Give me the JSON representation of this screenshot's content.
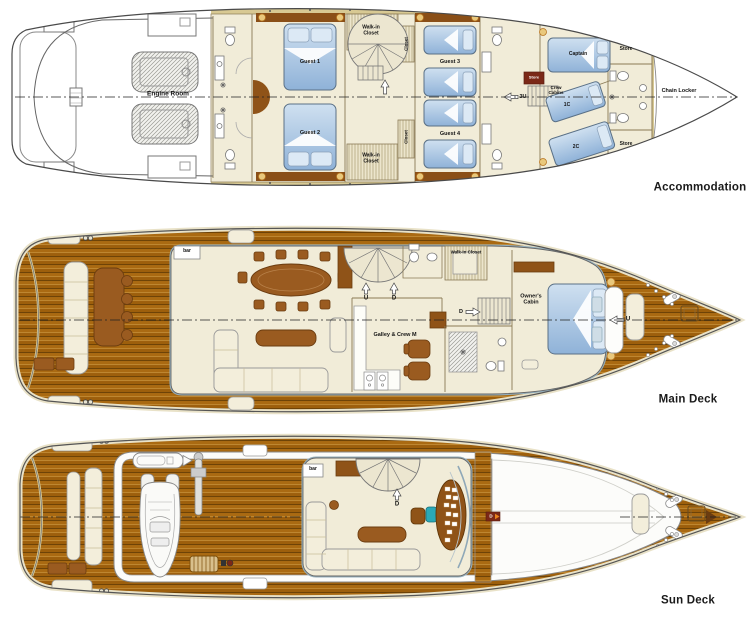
{
  "palette": {
    "background": "#ffffff",
    "hull_outline": "#4a4a4a",
    "teak_deck": "#a7660f",
    "teak_stripe": "#7d4e09",
    "gunwale_trim": "#d8c993",
    "interior_floor": "#f1ecd8",
    "bed_blue": "#a9c6e6",
    "furniture_brown": "#9a5b20",
    "store_red": "#7b2817",
    "helm_chair_teal": "#2aa9b8",
    "window_blue": "#93aebc"
  },
  "icons": [
    "double-bed-icon",
    "single-bed-icon",
    "bunk-bed-icon",
    "toilet-icon",
    "sink-icon",
    "shower-icon",
    "vent-fan-icon",
    "spiral-stairs-icon",
    "straight-stairs-icon",
    "up-arrow-icon",
    "down-arrow-icon",
    "left-arrow-icon",
    "right-arrow-icon",
    "dining-table-icon",
    "sofa-icon",
    "coffee-table-icon",
    "bar-counter-icon",
    "galley-stove-icon",
    "helm-console-icon",
    "helm-chair-icon",
    "engine-icon",
    "tender-boat-icon",
    "jetski-icon",
    "crane-icon",
    "boarding-steps-icon",
    "cleat-icon",
    "deck-hatch-icon",
    "anchor-windlass-icon"
  ],
  "decks": [
    {
      "id": "accommodation",
      "label": "Accommodation",
      "rooms": {
        "engine_room": "Engine Room",
        "guest1": "Guest 1",
        "guest2": "Guest 2",
        "guest3": "Guest 3",
        "guest4": "Guest 4",
        "walkin_closet_top": "Walk-in\nCloset",
        "walkin_closet_bottom": "Walk-in\nCloset",
        "closet_top": "Closet",
        "closet_bottom": "Closet",
        "store_mid": "Store",
        "crew_cabins": "Crew\nCabins",
        "cabin_1c": "1C",
        "cabin_2c": "2C",
        "captain": "Captain",
        "store_bow_top": "Store",
        "store_bow_bottom": "Store",
        "chain_locker": "Chain Locker"
      },
      "markers": {
        "stairs_up": "3U"
      }
    },
    {
      "id": "main-deck",
      "label": "Main Deck",
      "rooms": {
        "bar": "bar",
        "walkin_closet": "Walk-in Closet",
        "galley": "Galley & Crew M",
        "owners_cabin": "Owner's\nCabin"
      },
      "markers": {
        "stairs_up": "U",
        "stairs_down": "D",
        "crew_stairs_down": "D",
        "foredeck_stairs_up": "U"
      }
    },
    {
      "id": "sun-deck",
      "label": "Sun Deck",
      "rooms": {
        "bar": "bar"
      },
      "markers": {
        "stairs_down": "D",
        "helm_door": "D"
      }
    }
  ]
}
